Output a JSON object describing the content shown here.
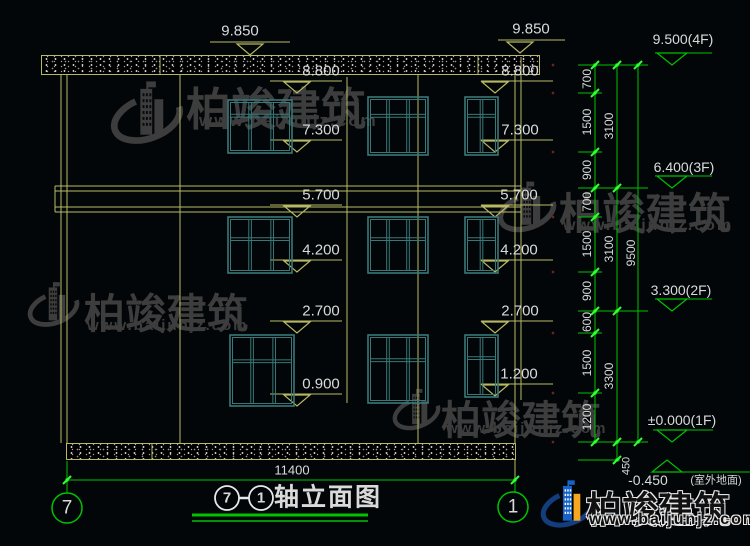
{
  "drawing": {
    "title": {
      "axis_left_bubble": "7",
      "axis_right_bubble": "1",
      "dash": "-",
      "text": "轴立面图"
    },
    "bottom_overall_dimension": "11400",
    "axis_bubbles": [
      {
        "label": "7"
      },
      {
        "label": "1"
      }
    ],
    "floor_markers": [
      "9.500(4F)",
      "6.400(3F)",
      "3.300(2F)",
      "±0.000(1F)",
      "-0.450(室外地面)"
    ],
    "level_labels_left": [
      "9.850",
      "8.800",
      "7.300",
      "5.700",
      "4.200",
      "2.700",
      "0.900"
    ],
    "level_labels_right": [
      "9.850",
      "8.800",
      "7.300",
      "5.700",
      "4.200",
      "2.700",
      "1.200"
    ],
    "chain_segments": [
      "700",
      "1500",
      "900",
      "700",
      "1500",
      "900",
      "600",
      "1500",
      "1200",
      "450"
    ],
    "chain_subtotals": [
      "3100",
      "3100",
      "3300"
    ],
    "chain_total": "9500"
  },
  "watermark": {
    "name": "柏竣建筑",
    "url": "www.baijunjz.com"
  },
  "colors": {
    "background": "#020608",
    "yellow": "#b9b965",
    "green": "#00c400",
    "bright_green": "#33ff33",
    "white_text": "#dadada",
    "teal": "#3a7878",
    "gray_watermark": "#3d3d3d",
    "logo_blue": "#1664c8",
    "logo_orange": "#f5a623",
    "logo_navy": "#143d7d",
    "red": "#6e2323"
  },
  "cad": {
    "speckle_bands": [
      {
        "x": 41,
        "y": 55,
        "w": 499,
        "h": 20
      },
      {
        "x": 66,
        "y": 443,
        "w": 450,
        "h": 17
      }
    ],
    "lines": [
      {
        "x1": 61,
        "y1": 75,
        "x2": 61,
        "y2": 443,
        "c": "y"
      },
      {
        "x1": 67,
        "y1": 75,
        "x2": 67,
        "y2": 443,
        "c": "y"
      },
      {
        "x1": 180,
        "y1": 75,
        "x2": 180,
        "y2": 443,
        "c": "y"
      },
      {
        "x1": 418,
        "y1": 75,
        "x2": 418,
        "y2": 443,
        "c": "y"
      },
      {
        "x1": 515,
        "y1": 75,
        "x2": 515,
        "y2": 443,
        "c": "y"
      },
      {
        "x1": 521,
        "y1": 57,
        "x2": 521,
        "y2": 400,
        "c": "y"
      },
      {
        "x1": 347,
        "y1": 77,
        "x2": 347,
        "y2": 403,
        "c": "y"
      },
      {
        "x1": 515,
        "y1": 460,
        "x2": 515,
        "y2": 479,
        "c": "y"
      },
      {
        "x1": 160,
        "y1": 56,
        "x2": 160,
        "y2": 74,
        "c": "y"
      },
      {
        "x1": 478,
        "y1": 56,
        "x2": 478,
        "y2": 74,
        "c": "y"
      },
      {
        "x1": 152,
        "y1": 444,
        "x2": 152,
        "y2": 459,
        "c": "y"
      },
      {
        "x1": 55,
        "y1": 186,
        "x2": 521,
        "y2": 186,
        "c": "y"
      },
      {
        "x1": 55,
        "y1": 191,
        "x2": 521,
        "y2": 191,
        "c": "y"
      },
      {
        "x1": 55,
        "y1": 207,
        "x2": 521,
        "y2": 207,
        "c": "y"
      },
      {
        "x1": 55,
        "y1": 212,
        "x2": 521,
        "y2": 212,
        "c": "y"
      },
      {
        "x1": 55,
        "y1": 186,
        "x2": 55,
        "y2": 212,
        "c": "y"
      },
      {
        "x1": 521,
        "y1": 186,
        "x2": 521,
        "y2": 212,
        "c": "y"
      },
      {
        "x1": 210,
        "y1": 42,
        "x2": 290,
        "y2": 42,
        "c": "y"
      },
      {
        "x1": 270,
        "y1": 81,
        "x2": 342,
        "y2": 81,
        "c": "y"
      },
      {
        "x1": 270,
        "y1": 140,
        "x2": 342,
        "y2": 140,
        "c": "y"
      },
      {
        "x1": 270,
        "y1": 205,
        "x2": 342,
        "y2": 205,
        "c": "y"
      },
      {
        "x1": 270,
        "y1": 260,
        "x2": 342,
        "y2": 260,
        "c": "y"
      },
      {
        "x1": 270,
        "y1": 321,
        "x2": 342,
        "y2": 321,
        "c": "y"
      },
      {
        "x1": 270,
        "y1": 394,
        "x2": 342,
        "y2": 394,
        "c": "y"
      },
      {
        "x1": 498,
        "y1": 40,
        "x2": 565,
        "y2": 40,
        "c": "y"
      },
      {
        "x1": 481,
        "y1": 81,
        "x2": 553,
        "y2": 81,
        "c": "y"
      },
      {
        "x1": 481,
        "y1": 140,
        "x2": 553,
        "y2": 140,
        "c": "y"
      },
      {
        "x1": 481,
        "y1": 205,
        "x2": 553,
        "y2": 205,
        "c": "y"
      },
      {
        "x1": 481,
        "y1": 260,
        "x2": 553,
        "y2": 260,
        "c": "y"
      },
      {
        "x1": 481,
        "y1": 321,
        "x2": 553,
        "y2": 321,
        "c": "y"
      },
      {
        "x1": 481,
        "y1": 384,
        "x2": 553,
        "y2": 384,
        "c": "y"
      },
      {
        "x1": 595,
        "y1": 65,
        "x2": 595,
        "y2": 442,
        "c": "g"
      },
      {
        "x1": 617,
        "y1": 65,
        "x2": 617,
        "y2": 460,
        "c": "g"
      },
      {
        "x1": 638,
        "y1": 65,
        "x2": 638,
        "y2": 442,
        "c": "g"
      },
      {
        "x1": 578,
        "y1": 65,
        "x2": 648,
        "y2": 65,
        "c": "g"
      },
      {
        "x1": 578,
        "y1": 188,
        "x2": 648,
        "y2": 188,
        "c": "g"
      },
      {
        "x1": 578,
        "y1": 311,
        "x2": 648,
        "y2": 311,
        "c": "g"
      },
      {
        "x1": 578,
        "y1": 442,
        "x2": 648,
        "y2": 442,
        "c": "g"
      },
      {
        "x1": 578,
        "y1": 93,
        "x2": 602,
        "y2": 93,
        "c": "g"
      },
      {
        "x1": 578,
        "y1": 152,
        "x2": 602,
        "y2": 152,
        "c": "g"
      },
      {
        "x1": 578,
        "y1": 217,
        "x2": 602,
        "y2": 217,
        "c": "g"
      },
      {
        "x1": 578,
        "y1": 272,
        "x2": 602,
        "y2": 272,
        "c": "g"
      },
      {
        "x1": 578,
        "y1": 333,
        "x2": 602,
        "y2": 333,
        "c": "g"
      },
      {
        "x1": 578,
        "y1": 393,
        "x2": 602,
        "y2": 393,
        "c": "g"
      },
      {
        "x1": 578,
        "y1": 460,
        "x2": 620,
        "y2": 460,
        "c": "g"
      },
      {
        "x1": 655,
        "y1": 53,
        "x2": 712,
        "y2": 53,
        "c": "g"
      },
      {
        "x1": 655,
        "y1": 176,
        "x2": 712,
        "y2": 176,
        "c": "g"
      },
      {
        "x1": 655,
        "y1": 299,
        "x2": 712,
        "y2": 299,
        "c": "g"
      },
      {
        "x1": 653,
        "y1": 430,
        "x2": 713,
        "y2": 430,
        "c": "g"
      },
      {
        "x1": 655,
        "y1": 472,
        "x2": 750,
        "y2": 472,
        "c": "g"
      },
      {
        "x1": 67,
        "y1": 480,
        "x2": 515,
        "y2": 480,
        "c": "g"
      },
      {
        "x1": 67,
        "y1": 461,
        "x2": 67,
        "y2": 493,
        "c": "g"
      },
      {
        "x1": 515,
        "y1": 479,
        "x2": 515,
        "y2": 492,
        "c": "g"
      },
      {
        "x1": 192,
        "y1": 515,
        "x2": 368,
        "y2": 515,
        "c": "g",
        "w": 3
      },
      {
        "x1": 192,
        "y1": 521,
        "x2": 368,
        "y2": 521,
        "c": "g",
        "w": 1.5
      },
      {
        "x1": 239,
        "y1": 498,
        "x2": 249,
        "y2": 498,
        "c": "w",
        "w": 2.5
      }
    ],
    "arrows": [
      {
        "cx": 250,
        "y": 55,
        "d": "down",
        "c": "y"
      },
      {
        "cx": 297,
        "y": 93,
        "d": "down",
        "c": "y"
      },
      {
        "cx": 297,
        "y": 152,
        "d": "down",
        "c": "y"
      },
      {
        "cx": 297,
        "y": 217,
        "d": "down",
        "c": "y"
      },
      {
        "cx": 297,
        "y": 272,
        "d": "down",
        "c": "y"
      },
      {
        "cx": 297,
        "y": 333,
        "d": "down",
        "c": "y"
      },
      {
        "cx": 297,
        "y": 406,
        "d": "down",
        "c": "y"
      },
      {
        "cx": 520,
        "y": 53,
        "d": "down",
        "c": "y"
      },
      {
        "cx": 495,
        "y": 93,
        "d": "down",
        "c": "y"
      },
      {
        "cx": 495,
        "y": 152,
        "d": "down",
        "c": "y"
      },
      {
        "cx": 495,
        "y": 217,
        "d": "down",
        "c": "y"
      },
      {
        "cx": 495,
        "y": 272,
        "d": "down",
        "c": "y"
      },
      {
        "cx": 495,
        "y": 333,
        "d": "down",
        "c": "y"
      },
      {
        "cx": 495,
        "y": 396,
        "d": "down",
        "c": "y"
      },
      {
        "cx": 672,
        "y": 65,
        "d": "down",
        "c": "g"
      },
      {
        "cx": 672,
        "y": 188,
        "d": "down",
        "c": "g"
      },
      {
        "cx": 672,
        "y": 311,
        "d": "down",
        "c": "g"
      },
      {
        "cx": 672,
        "y": 442,
        "d": "down",
        "c": "g"
      },
      {
        "cx": 667,
        "y": 460,
        "d": "up",
        "c": "g"
      }
    ],
    "ticks": [
      {
        "x": 595,
        "y": 65
      },
      {
        "x": 595,
        "y": 93
      },
      {
        "x": 595,
        "y": 152
      },
      {
        "x": 595,
        "y": 188
      },
      {
        "x": 595,
        "y": 217
      },
      {
        "x": 595,
        "y": 272
      },
      {
        "x": 595,
        "y": 311
      },
      {
        "x": 595,
        "y": 333
      },
      {
        "x": 595,
        "y": 393
      },
      {
        "x": 595,
        "y": 442
      },
      {
        "x": 617,
        "y": 65
      },
      {
        "x": 617,
        "y": 188
      },
      {
        "x": 617,
        "y": 311
      },
      {
        "x": 617,
        "y": 442
      },
      {
        "x": 617,
        "y": 460
      },
      {
        "x": 638,
        "y": 65
      },
      {
        "x": 638,
        "y": 442
      },
      {
        "x": 67,
        "y": 480
      },
      {
        "x": 515,
        "y": 480
      }
    ],
    "red_dots": [
      {
        "x": 553,
        "y": 65
      },
      {
        "x": 553,
        "y": 93
      },
      {
        "x": 553,
        "y": 152
      },
      {
        "x": 553,
        "y": 217
      },
      {
        "x": 553,
        "y": 272
      },
      {
        "x": 553,
        "y": 333
      },
      {
        "x": 553,
        "y": 393
      },
      {
        "x": 553,
        "y": 442
      }
    ],
    "circles": [
      {
        "cx": 67,
        "cy": 508,
        "r": 15,
        "c": "g"
      },
      {
        "cx": 513,
        "cy": 507,
        "r": 15,
        "c": "g"
      },
      {
        "cx": 227,
        "cy": 498,
        "r": 12,
        "c": "w"
      },
      {
        "cx": 261,
        "cy": 498,
        "r": 12,
        "c": "w"
      }
    ],
    "windows": [
      {
        "x": 228,
        "y": 100,
        "w": 64,
        "h": 53,
        "t": 0.27,
        "ms": [
          0.345,
          0.69
        ]
      },
      {
        "x": 368,
        "y": 97,
        "w": 60,
        "h": 58,
        "t": 0.3,
        "ms": [
          0.333,
          0.667
        ]
      },
      {
        "x": 465,
        "y": 97,
        "w": 33,
        "h": 58,
        "t": 0.3,
        "ms": [
          0.5
        ]
      },
      {
        "x": 228,
        "y": 217,
        "w": 64,
        "h": 56,
        "t": 0.37,
        "ms": [
          0.345,
          0.69
        ]
      },
      {
        "x": 368,
        "y": 217,
        "w": 60,
        "h": 56,
        "t": 0.37,
        "ms": [
          0.333,
          0.667
        ]
      },
      {
        "x": 465,
        "y": 217,
        "w": 33,
        "h": 56,
        "t": 0.37,
        "ms": [
          0.5
        ]
      },
      {
        "x": 230,
        "y": 335,
        "w": 64,
        "h": 71,
        "t": 0.35,
        "ms": [
          0.345,
          0.69
        ]
      },
      {
        "x": 368,
        "y": 335,
        "w": 60,
        "h": 68,
        "t": 0.35,
        "ms": [
          0.333,
          0.667
        ]
      },
      {
        "x": 465,
        "y": 335,
        "w": 33,
        "h": 62,
        "t": 0.35,
        "ms": [
          0.5
        ]
      }
    ],
    "texts": [
      {
        "t": "9.850",
        "x": 240,
        "y": 31,
        "fs": 15,
        "name": "level-label"
      },
      {
        "t": "8.800",
        "x": 321,
        "y": 71,
        "fs": 15,
        "name": "level-label"
      },
      {
        "t": "7.300",
        "x": 321,
        "y": 130,
        "fs": 15,
        "name": "level-label"
      },
      {
        "t": "5.700",
        "x": 321,
        "y": 195,
        "fs": 15,
        "name": "level-label"
      },
      {
        "t": "4.200",
        "x": 321,
        "y": 250,
        "fs": 15,
        "name": "level-label"
      },
      {
        "t": "2.700",
        "x": 321,
        "y": 311,
        "fs": 15,
        "name": "level-label"
      },
      {
        "t": "0.900",
        "x": 321,
        "y": 384,
        "fs": 15,
        "name": "level-label"
      },
      {
        "t": "9.850",
        "x": 531,
        "y": 29,
        "fs": 15,
        "name": "level-label"
      },
      {
        "t": "8.800",
        "x": 520,
        "y": 71,
        "fs": 15,
        "name": "level-label"
      },
      {
        "t": "7.300",
        "x": 520,
        "y": 130,
        "fs": 15,
        "name": "level-label"
      },
      {
        "t": "5.700",
        "x": 519,
        "y": 195,
        "fs": 15,
        "name": "level-label"
      },
      {
        "t": "4.200",
        "x": 519,
        "y": 250,
        "fs": 15,
        "name": "level-label"
      },
      {
        "t": "2.700",
        "x": 520,
        "y": 311,
        "fs": 15,
        "name": "level-label"
      },
      {
        "t": "1.200",
        "x": 519,
        "y": 374,
        "fs": 15,
        "name": "level-label"
      },
      {
        "t": "9.500(4F)",
        "x": 683,
        "y": 39,
        "fs": 14,
        "name": "floor-marker-label"
      },
      {
        "t": "6.400(3F)",
        "x": 684,
        "y": 167,
        "fs": 14,
        "name": "floor-marker-label"
      },
      {
        "t": "3.300(2F)",
        "x": 681,
        "y": 290,
        "fs": 14,
        "name": "floor-marker-label"
      },
      {
        "t": "±0.000(1F)",
        "x": 682,
        "y": 420,
        "fs": 14,
        "name": "floor-marker-label"
      },
      {
        "t": "-0.450",
        "x": 648,
        "y": 480,
        "fs": 14,
        "name": "floor-marker-label"
      },
      {
        "t": "(室外地面)",
        "x": 716,
        "y": 481,
        "fs": 11,
        "name": "floor-marker-label"
      },
      {
        "t": "700",
        "x": 587,
        "y": 79,
        "fs": 12,
        "rot": 1,
        "name": "chain-dim"
      },
      {
        "t": "1500",
        "x": 587,
        "y": 122,
        "fs": 12,
        "rot": 1,
        "name": "chain-dim"
      },
      {
        "t": "900",
        "x": 587,
        "y": 170,
        "fs": 12,
        "rot": 1,
        "name": "chain-dim"
      },
      {
        "t": "700",
        "x": 587,
        "y": 202,
        "fs": 12,
        "rot": 1,
        "name": "chain-dim"
      },
      {
        "t": "1500",
        "x": 587,
        "y": 244,
        "fs": 12,
        "rot": 1,
        "name": "chain-dim"
      },
      {
        "t": "900",
        "x": 587,
        "y": 291,
        "fs": 12,
        "rot": 1,
        "name": "chain-dim"
      },
      {
        "t": "600",
        "x": 587,
        "y": 322,
        "fs": 12,
        "rot": 1,
        "name": "chain-dim"
      },
      {
        "t": "1500",
        "x": 587,
        "y": 363,
        "fs": 12,
        "rot": 1,
        "name": "chain-dim"
      },
      {
        "t": "1200",
        "x": 587,
        "y": 417,
        "fs": 12,
        "rot": 1,
        "name": "chain-dim"
      },
      {
        "t": "3100",
        "x": 609,
        "y": 126,
        "fs": 12,
        "rot": 1,
        "name": "chain-subtotal-dim"
      },
      {
        "t": "3100",
        "x": 609,
        "y": 249,
        "fs": 12,
        "rot": 1,
        "name": "chain-subtotal-dim"
      },
      {
        "t": "3300",
        "x": 609,
        "y": 376,
        "fs": 12,
        "rot": 1,
        "name": "chain-subtotal-dim"
      },
      {
        "t": "9500",
        "x": 631,
        "y": 253,
        "fs": 12,
        "rot": 1,
        "name": "chain-total-dim"
      },
      {
        "t": "450",
        "x": 627,
        "y": 466,
        "fs": 11,
        "rot": 1,
        "name": "chain-dim"
      },
      {
        "t": "11400",
        "x": 292,
        "y": 470,
        "fs": 13,
        "name": "overall-width-dim"
      },
      {
        "t": "7",
        "x": 67,
        "y": 508,
        "fs": 19,
        "name": "axis-bubble-digit"
      },
      {
        "t": "1",
        "x": 513,
        "y": 507,
        "fs": 19,
        "name": "axis-bubble-digit"
      },
      {
        "t": "7",
        "x": 227,
        "y": 498,
        "fs": 15,
        "bold": 1,
        "name": "title-axis-digit"
      },
      {
        "t": "1",
        "x": 261,
        "y": 498,
        "fs": 15,
        "bold": 1,
        "name": "title-axis-digit"
      },
      {
        "t": "轴立面图",
        "x": 274,
        "y": 498,
        "fs": 25,
        "bold": 1,
        "anchor": "left",
        "ls": 2,
        "name": "drawing-title"
      }
    ],
    "watermarks": [
      {
        "type": "gray",
        "lx": 110,
        "ly": 77,
        "lsz": 74,
        "tx": 186,
        "ty": 73,
        "tfs": 45,
        "ux": 199,
        "uy": 111,
        "ufs": 17
      },
      {
        "type": "gray",
        "lx": 497,
        "ly": 178,
        "lsz": 60,
        "tx": 559,
        "ty": 180,
        "tfs": 43,
        "ux": 563,
        "uy": 217,
        "ufs": 16
      },
      {
        "type": "gray",
        "lx": 27,
        "ly": 279,
        "lsz": 53,
        "tx": 84,
        "ty": 280,
        "tfs": 41,
        "ux": 87,
        "uy": 317,
        "ufs": 15
      },
      {
        "type": "gray",
        "lx": 392,
        "ly": 386,
        "lsz": 49,
        "tx": 441,
        "ty": 388,
        "tfs": 40,
        "ux": 446,
        "uy": 420,
        "ufs": 15
      },
      {
        "type": "color",
        "lx": 540,
        "ly": 477,
        "lsz": 56,
        "tx": 586,
        "ty": 481,
        "tfs": 36,
        "ux": 589,
        "uy": 511,
        "ufs": 16
      }
    ]
  }
}
